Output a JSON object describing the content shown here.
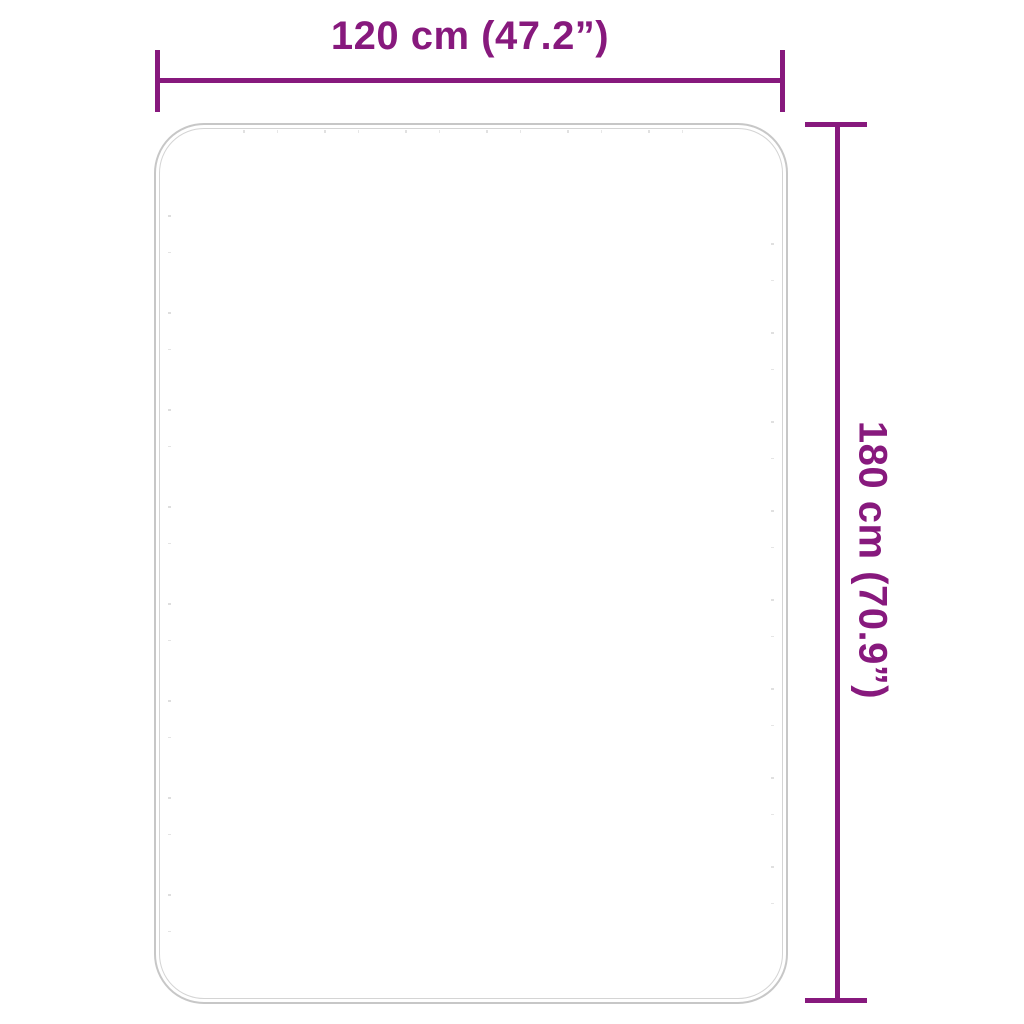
{
  "diagram": {
    "type": "product-dimension-diagram",
    "labels": {
      "width": "120 cm (47.2”)",
      "height": "180 cm (70.9”)"
    },
    "colors": {
      "accent": "#87197D",
      "rug_outline": "#C7C7C7",
      "rug_outline_inner": "#D4D4D4"
    }
  }
}
